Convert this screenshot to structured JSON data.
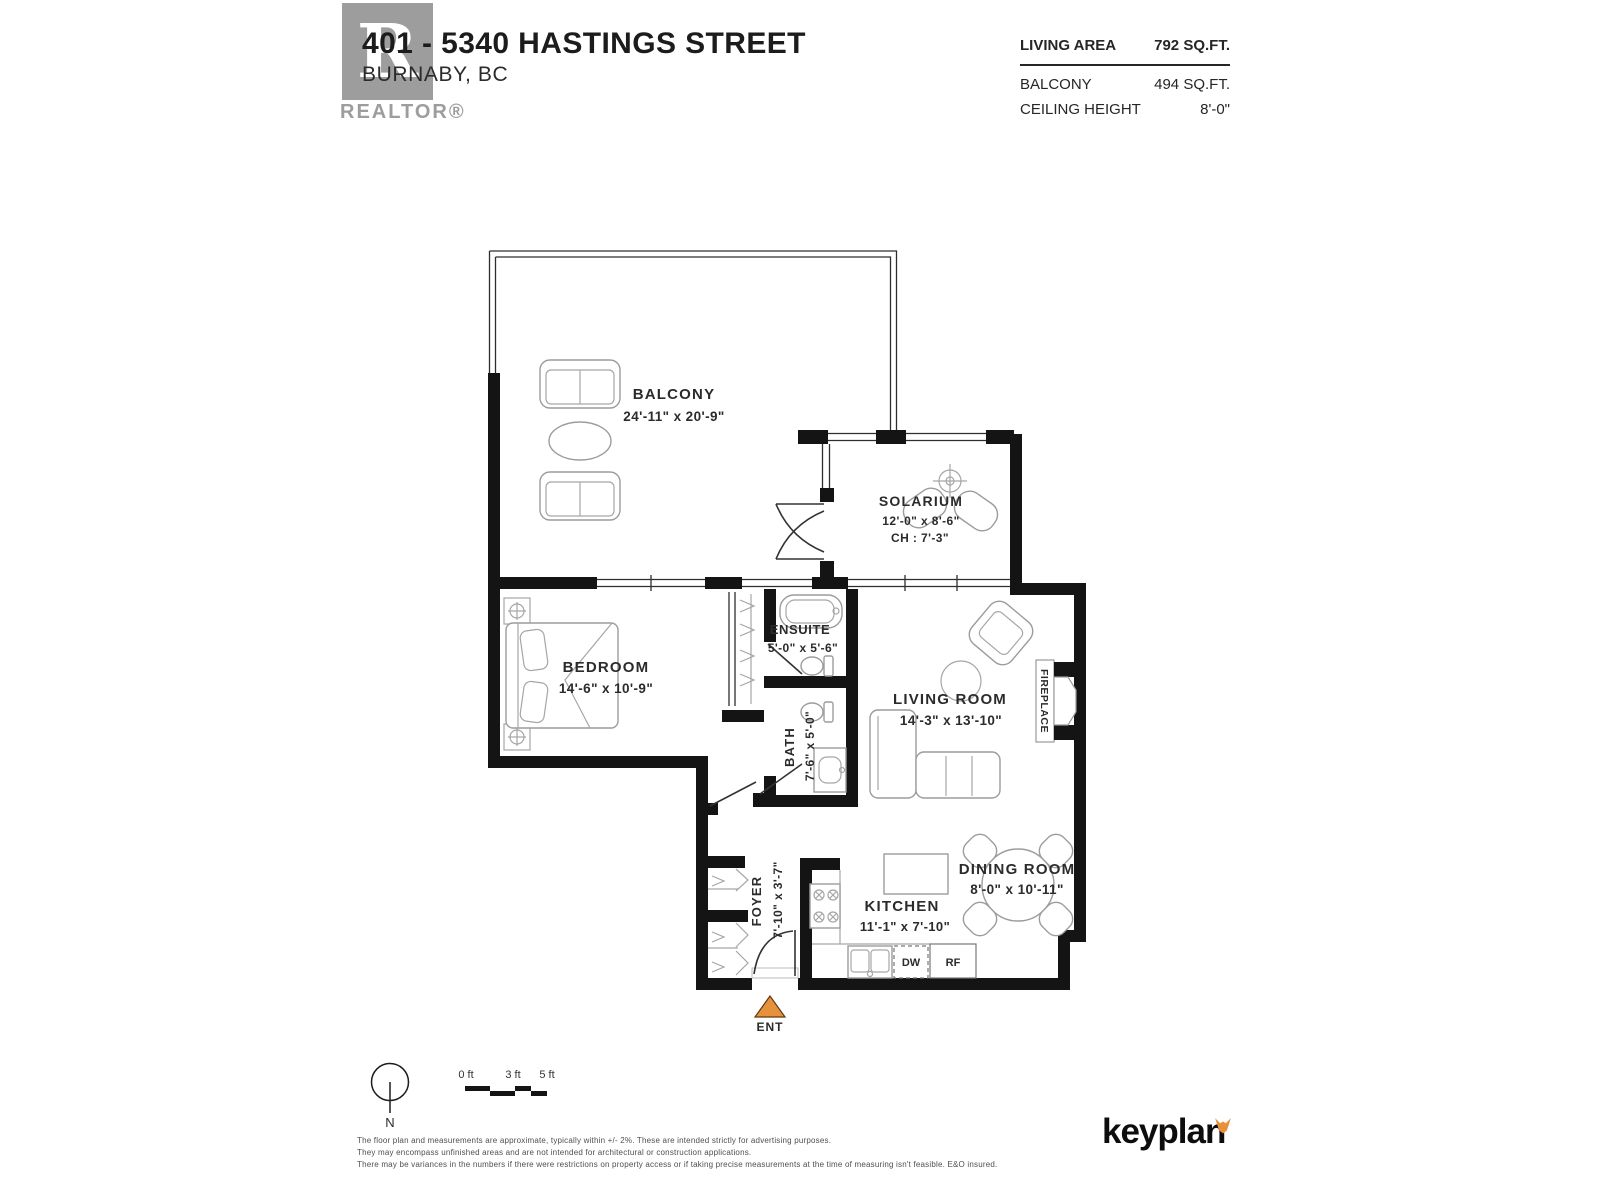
{
  "header": {
    "address": "401 - 5340 HASTINGS STREET",
    "city": "BURNABY, BC",
    "logo_letter": "R",
    "logo_wordmark": "REALTOR®"
  },
  "stats": {
    "living_area_label": "LIVING AREA",
    "living_area_value": "792 SQ.FT.",
    "balcony_label": "BALCONY",
    "balcony_value": "494 SQ.FT.",
    "ceiling_label": "CEILING HEIGHT",
    "ceiling_value": "8'-0\""
  },
  "rooms": {
    "balcony": {
      "name": "BALCONY",
      "dims": "24'-11\" x 20'-9\""
    },
    "solarium": {
      "name": "SOLARIUM",
      "dims": "12'-0\" x 8'-6\"",
      "ceiling": "CH : 7'-3\""
    },
    "bedroom": {
      "name": "BEDROOM",
      "dims": "14'-6\" x 10'-9\""
    },
    "ensuite": {
      "name": "ENSUITE",
      "dims": "5'-0\" x 5'-6\""
    },
    "bath": {
      "name": "BATH",
      "dims": "7'-6\" x 5'-0\""
    },
    "living_room": {
      "name": "LIVING ROOM",
      "dims": "14'-3\" x 13'-10\""
    },
    "dining_room": {
      "name": "DINING ROOM",
      "dims": "8'-0\" x 10'-11\""
    },
    "kitchen": {
      "name": "KITCHEN",
      "dims": "11'-1\" x 7'-10\""
    },
    "foyer": {
      "name": "FOYER",
      "dims": "7'-10\" x 3'-7\""
    },
    "fireplace_label": "FIREPLACE"
  },
  "appliances": {
    "dishwasher": "DW",
    "fridge": "RF"
  },
  "entry_label": "ENT",
  "compass_label": "N",
  "scale": {
    "t0": "0 ft",
    "t3": "3 ft",
    "t5": "5 ft"
  },
  "disclaimer": {
    "line1": "The floor plan and measurements are approximate, typically within +/- 2%. These are intended strictly for advertising purposes.",
    "line2": "They may encompass unfinished areas and are not intended for architectural or construction applications.",
    "line3": "There may be variances in the numbers if there were restrictions on property access or if taking precise measurements at the time of measuring isn't feasible. E&O insured."
  },
  "brand": "keyplan",
  "colors": {
    "accent": "#E8913C",
    "wall": "#141414",
    "logo_grey": "#9D9D9D"
  }
}
